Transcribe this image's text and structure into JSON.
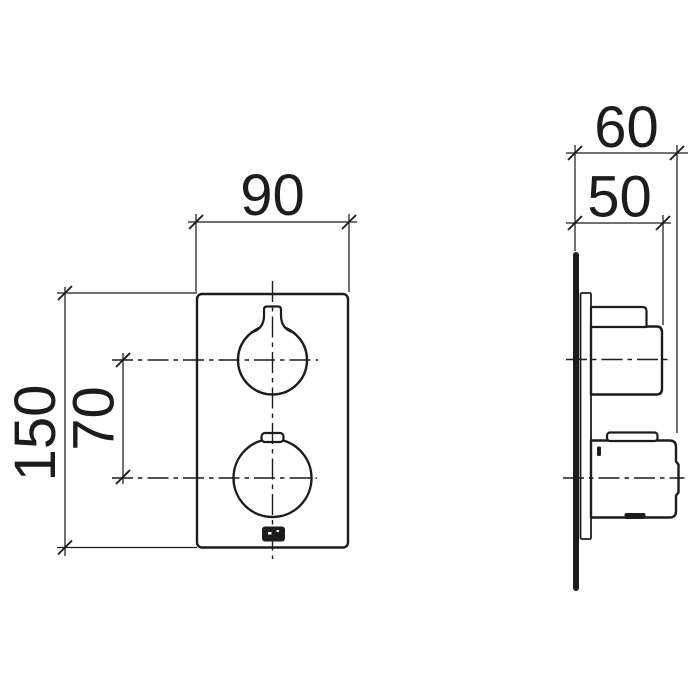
{
  "colors": {
    "ink": "#1c1c1c",
    "paper": "#ffffff"
  },
  "drawing": {
    "kind": "technical-dimension-drawing",
    "units": "mm",
    "views": {
      "front": {
        "dimensions": {
          "width_mm": "90",
          "height_mm": "150",
          "handle_spacing_mm": "70"
        }
      },
      "side": {
        "dimensions": {
          "depth_total_mm": "60",
          "depth_upper_handle_mm": "50"
        }
      }
    }
  }
}
